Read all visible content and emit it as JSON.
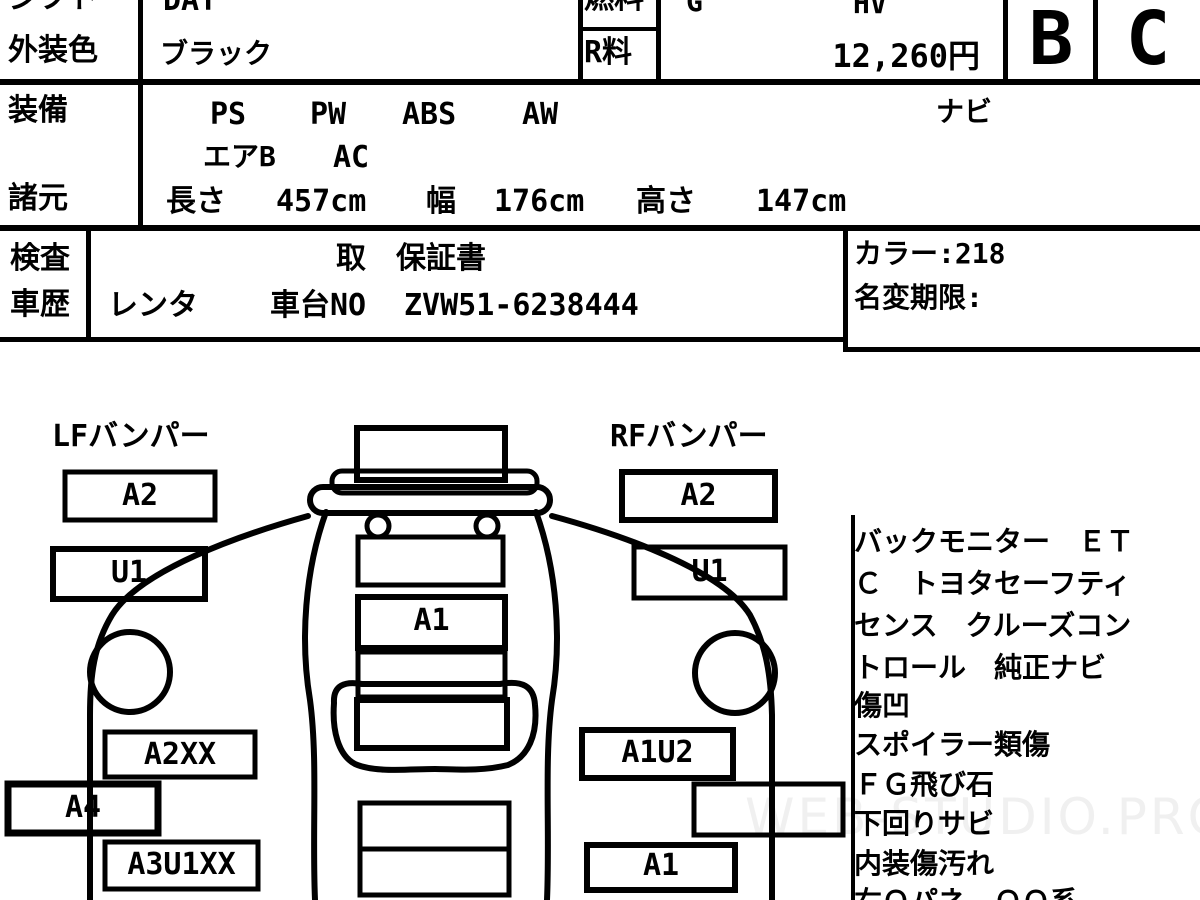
{
  "header": {
    "shift_label": "シフト",
    "shift_value": "DAT",
    "fuel_label": "燃料",
    "fuel_value": "G",
    "hybrid": "HV",
    "exterior_color_label": "外装色",
    "exterior_color_value": "ブラック",
    "recycle_fee_label": "R料",
    "recycle_fee_value": "12,260円",
    "grade_overall": "B",
    "grade_interior": "C",
    "equipment_label": "装備",
    "equipment_items": [
      "PS",
      "PW",
      "ABS",
      "AW"
    ],
    "equipment_navi": "ナビ",
    "equipment_line2": [
      "エアB",
      "AC"
    ],
    "spec_label": "諸元",
    "length_label": "長さ",
    "length_value": "457cm",
    "width_label": "幅",
    "width_value": "176cm",
    "height_label": "高さ",
    "height_value": "147cm"
  },
  "inspection": {
    "inspect_label": "検査",
    "history_label": "車歴",
    "warranty_line": "取　保証書",
    "history_value": "レンタ",
    "chassis_label": "車台NO",
    "chassis_no": "ZVW51-6238444",
    "color_code": "カラー:218",
    "name_change_limit": "名変期限:"
  },
  "diagram": {
    "lf_bumper_label": "LFバンパー",
    "rf_bumper_label": "RFバンパー",
    "lf_a2": "A2",
    "lf_u1": "U1",
    "lf_a2xx": "A2XX",
    "lf_a4": "A4",
    "lf_a3u1xx": "A3U1XX",
    "center_a1": "A1",
    "rf_a2": "A2",
    "rf_u1": "U1",
    "rf_a1u2": "A1U2",
    "rf_a1": "A1"
  },
  "notes": {
    "lines": [
      "バックモニター　ＥＴ",
      "Ｃ　トヨタセーフティ",
      "センス　クルーズコン",
      "トロール　純正ナビ",
      "傷凹",
      "スポイラー類傷",
      "ＦＧ飛び石",
      "下回りサビ",
      "内装傷汚れ",
      "右Ｑパネ　ＱＱ系"
    ]
  },
  "watermark": "WEB-STUDIO.PRO"
}
